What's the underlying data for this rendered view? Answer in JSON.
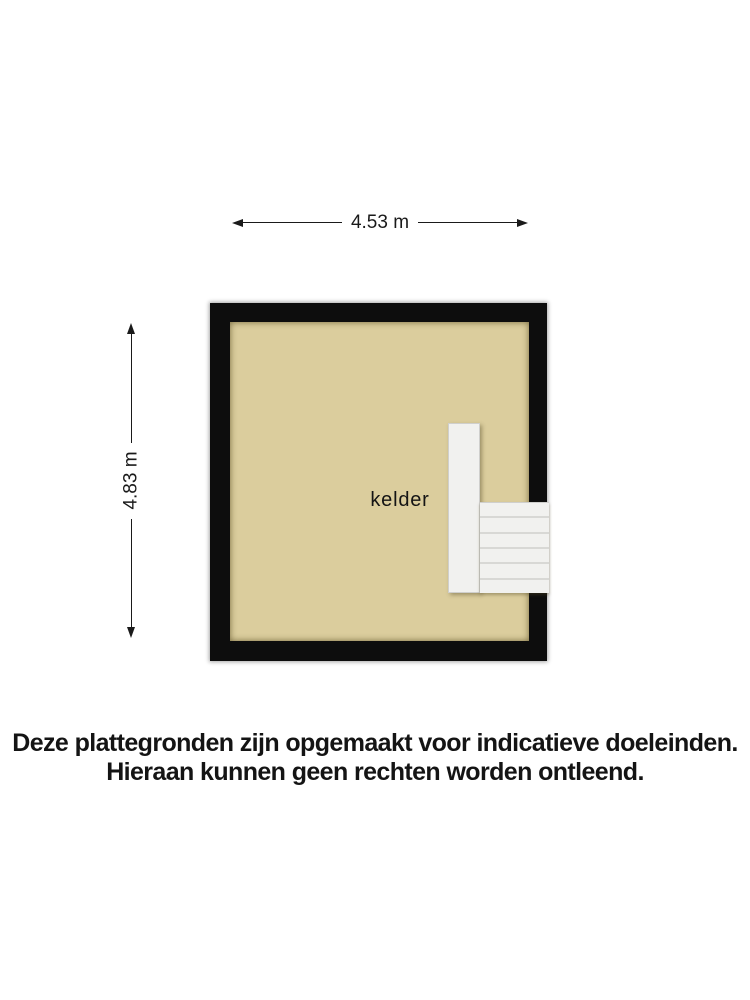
{
  "plan": {
    "room_label": "kelder",
    "width_dimension_label": "4.53 m",
    "height_dimension_label": "4.83 m"
  },
  "disclaimer": {
    "line1": "Deze plattegronden zijn opgemaakt voor indicatieve doeleinden.",
    "line2": "Hieraan kunnen geen rechten worden ontleend."
  },
  "colors": {
    "background": "#ffffff",
    "wall": "#0d0d0d",
    "floor": "#dbcd9d",
    "stair": "#f1f1ef",
    "stair_edge": "#cfcfcd",
    "dimension": "#1a1a1a",
    "text": "#141414"
  }
}
